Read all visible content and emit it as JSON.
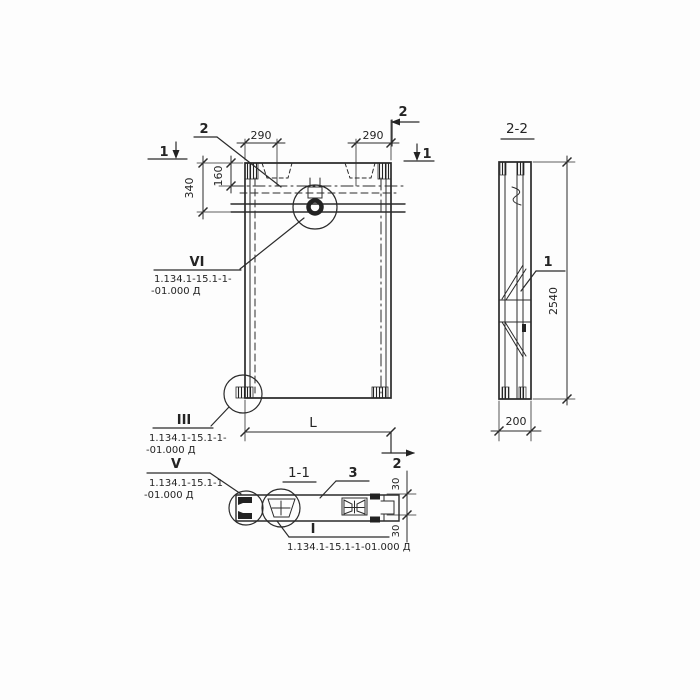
{
  "front_view": {
    "marker_1_left": "1",
    "marker_1_right": "1",
    "marker_2_top": "2",
    "marker_2_bottom": "2",
    "label_2": "2",
    "dim_290_left": "290",
    "dim_290_right": "290",
    "dim_340": "340",
    "dim_160": "160",
    "dim_length": "L",
    "callout_vi": {
      "numeral": "VI",
      "ref_line1": "1.134.1-15.1-1-",
      "ref_line2": "-01.000 Д"
    },
    "callout_iii": {
      "numeral": "III",
      "ref_line1": "1.134.1-15.1-1-",
      "ref_line2": "-01.000 Д"
    }
  },
  "section_2_2": {
    "title": "2-2",
    "dim_height": "2540",
    "dim_width": "200",
    "label_1": "1"
  },
  "plan_1_1": {
    "title": "1-1",
    "label_3": "3",
    "dim_30_top": "30",
    "dim_30_bottom": "30",
    "callout_v": {
      "numeral": "V",
      "ref_line1": "1.134.1-15.1-1",
      "ref_line2": "-01.000 Д"
    },
    "callout_i": {
      "numeral": "I",
      "ref_line1": "1.134.1-15.1-1-01.000 Д"
    }
  },
  "colors": {
    "ink": "#2b2b2b",
    "paper": "#fdfdfd"
  }
}
